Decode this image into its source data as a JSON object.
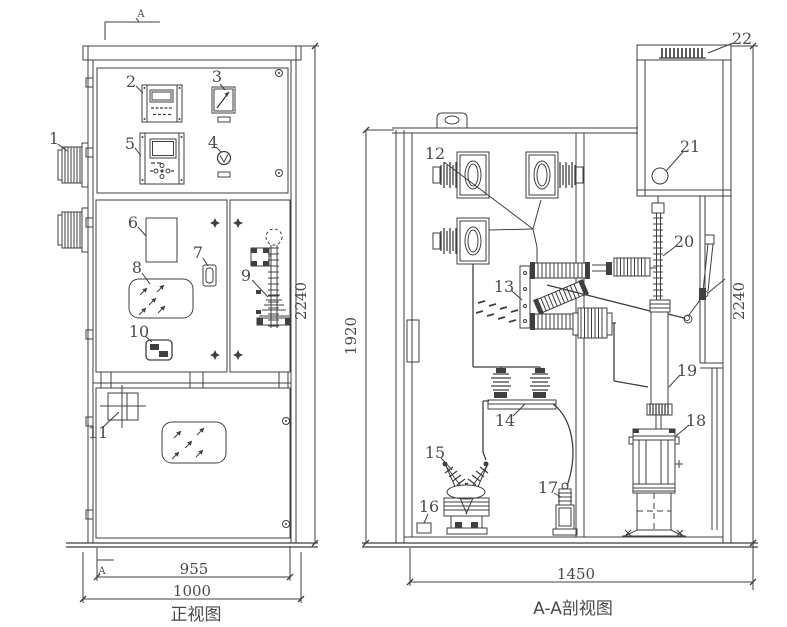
{
  "page": {
    "background": "#ffffff",
    "line_color": "#3f3f3f",
    "text_color": "#4a4a4a"
  },
  "front_view": {
    "caption": "正视图",
    "section_marker_top": "A",
    "section_marker_bottom": "A",
    "dim_inner_width": "955",
    "dim_outer_width": "1000",
    "dim_height": "2240"
  },
  "section_view": {
    "caption": "A-A剖视图",
    "dim_width": "1450",
    "dim_inner_height": "1920",
    "dim_outer_height": "2240"
  },
  "callouts": {
    "c1": "1",
    "c2": "2",
    "c3": "3",
    "c4": "4",
    "c5": "5",
    "c6": "6",
    "c7": "7",
    "c8": "8",
    "c9": "9",
    "c10": "10",
    "c11": "11",
    "c12": "12",
    "c13": "13",
    "c14": "14",
    "c15": "15",
    "c16": "16",
    "c17": "17",
    "c18": "18",
    "c19": "19",
    "c20": "20",
    "c21": "21",
    "c22": "22"
  }
}
